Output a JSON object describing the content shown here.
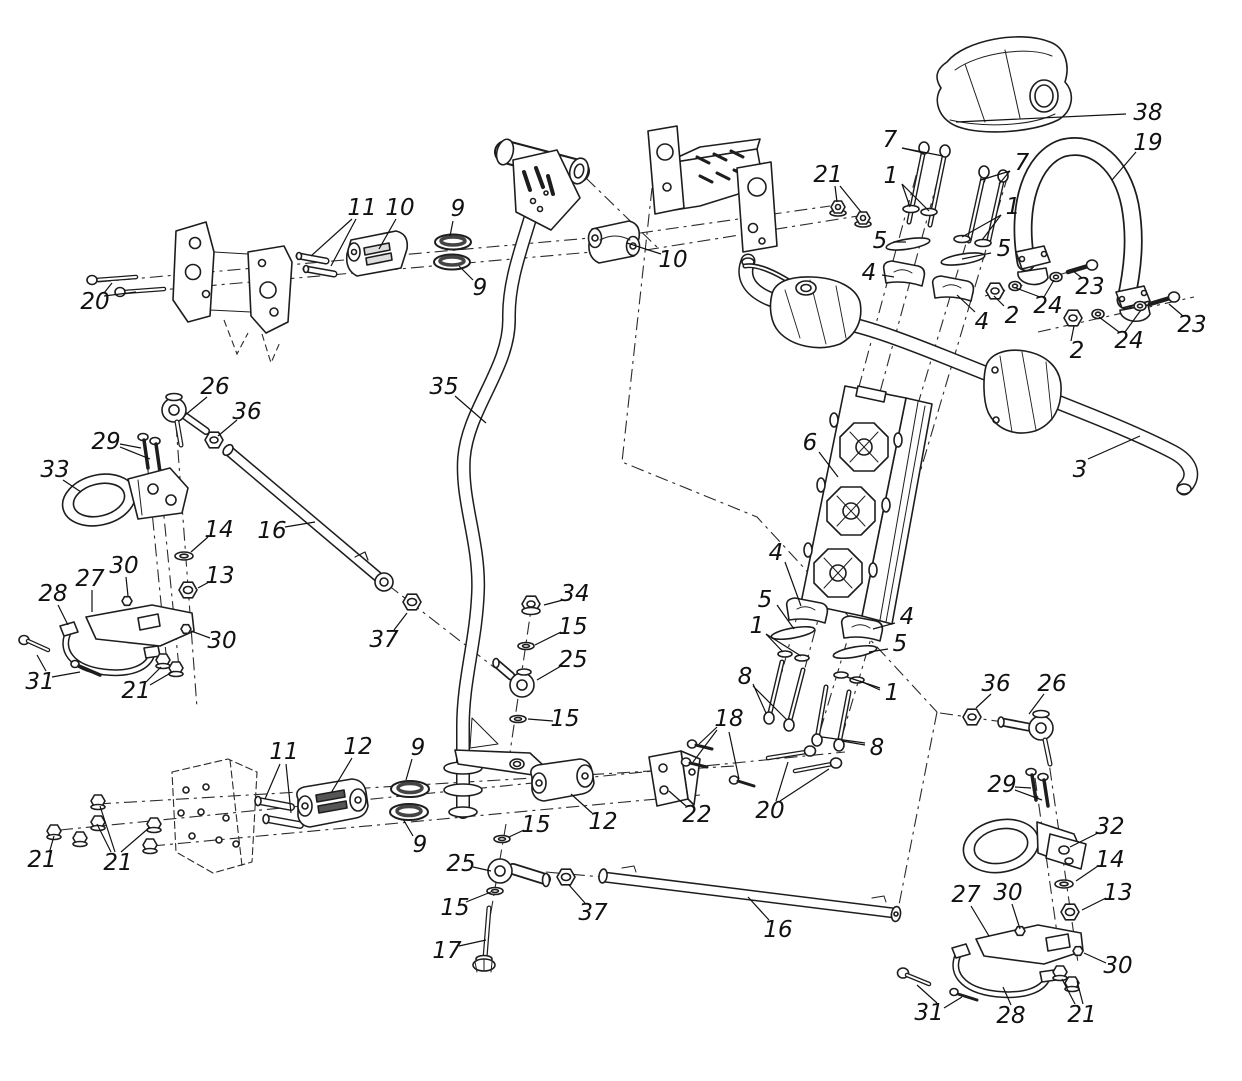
{
  "figure": {
    "kind": "exploded-parts-diagram",
    "subject": "steering assembly"
  },
  "style": {
    "line_color": "#1d1d1d",
    "label_color": "#111111",
    "background": "#ffffff"
  },
  "labels": [
    {
      "t": "38",
      "x": 1148,
      "y": 113,
      "L": [
        [
          1126,
          114,
          956,
          122
        ]
      ]
    },
    {
      "t": "19",
      "x": 1148,
      "y": 143,
      "L": [
        [
          1136,
          152,
          1112,
          180
        ]
      ]
    },
    {
      "t": "7",
      "x": 890,
      "y": 140,
      "L": [
        [
          902,
          148,
          924,
          153
        ],
        [
          902,
          148,
          943,
          156
        ]
      ]
    },
    {
      "t": "1",
      "x": 891,
      "y": 176,
      "L": [
        [
          902,
          184,
          910,
          207
        ],
        [
          902,
          184,
          929,
          211
        ]
      ]
    },
    {
      "t": "7",
      "x": 1022,
      "y": 163,
      "L": [
        [
          1010,
          171,
          981,
          180
        ],
        [
          1010,
          171,
          999,
          184
        ]
      ]
    },
    {
      "t": "1",
      "x": 1013,
      "y": 207,
      "L": [
        [
          1001,
          215,
          962,
          237
        ],
        [
          1001,
          215,
          982,
          240
        ]
      ]
    },
    {
      "t": "5",
      "x": 880,
      "y": 241,
      "L": [
        [
          893,
          242,
          906,
          242
        ]
      ]
    },
    {
      "t": "4",
      "x": 869,
      "y": 273,
      "L": [
        [
          882,
          275,
          894,
          277
        ]
      ]
    },
    {
      "t": "5",
      "x": 1004,
      "y": 249,
      "L": [
        [
          991,
          253,
          962,
          259
        ]
      ]
    },
    {
      "t": "4",
      "x": 982,
      "y": 322,
      "L": [
        [
          975,
          312,
          957,
          295
        ]
      ]
    },
    {
      "t": "21",
      "x": 828,
      "y": 175,
      "L": [
        [
          835,
          186,
          837,
          202
        ],
        [
          840,
          186,
          861,
          212
        ]
      ]
    },
    {
      "t": "2",
      "x": 1012,
      "y": 316,
      "L": [
        [
          1004,
          306,
          994,
          296
        ]
      ]
    },
    {
      "t": "24",
      "x": 1048,
      "y": 306,
      "L": [
        [
          1040,
          297,
          1016,
          288
        ],
        [
          1044,
          297,
          1054,
          280
        ]
      ]
    },
    {
      "t": "23",
      "x": 1090,
      "y": 287,
      "L": [
        [
          1082,
          278,
          1073,
          271
        ]
      ]
    },
    {
      "t": "2",
      "x": 1077,
      "y": 351,
      "L": [
        [
          1071,
          341,
          1074,
          326
        ]
      ]
    },
    {
      "t": "24",
      "x": 1129,
      "y": 341,
      "L": [
        [
          1119,
          332,
          1099,
          317
        ],
        [
          1125,
          332,
          1141,
          310
        ]
      ]
    },
    {
      "t": "23",
      "x": 1192,
      "y": 325,
      "L": [
        [
          1183,
          316,
          1169,
          304
        ]
      ]
    },
    {
      "t": "3",
      "x": 1080,
      "y": 470,
      "L": [
        [
          1088,
          459,
          1140,
          436
        ]
      ]
    },
    {
      "t": "11",
      "x": 362,
      "y": 208,
      "L": [
        [
          352,
          219,
          311,
          256
        ],
        [
          356,
          219,
          331,
          266
        ]
      ]
    },
    {
      "t": "10",
      "x": 400,
      "y": 208,
      "L": [
        [
          396,
          219,
          379,
          249
        ]
      ]
    },
    {
      "t": "9",
      "x": 458,
      "y": 209,
      "L": [
        [
          453,
          221,
          450,
          236
        ]
      ]
    },
    {
      "t": "9",
      "x": 480,
      "y": 288,
      "L": [
        [
          473,
          280,
          459,
          266
        ]
      ]
    },
    {
      "t": "10",
      "x": 673,
      "y": 260,
      "L": [
        [
          661,
          254,
          627,
          243
        ]
      ]
    },
    {
      "t": "20",
      "x": 95,
      "y": 302,
      "L": [
        [
          104,
          293,
          112,
          283
        ],
        [
          104,
          296,
          136,
          292
        ]
      ]
    },
    {
      "t": "35",
      "x": 444,
      "y": 387,
      "L": [
        [
          455,
          396,
          486,
          423
        ]
      ]
    },
    {
      "t": "6",
      "x": 810,
      "y": 443,
      "L": [
        [
          819,
          452,
          838,
          477
        ]
      ]
    },
    {
      "t": "16",
      "x": 272,
      "y": 531,
      "L": [
        [
          285,
          527,
          315,
          522
        ]
      ]
    },
    {
      "t": "26",
      "x": 215,
      "y": 387,
      "L": [
        [
          207,
          397,
          184,
          416
        ]
      ]
    },
    {
      "t": "36",
      "x": 247,
      "y": 412,
      "L": [
        [
          237,
          420,
          218,
          436
        ]
      ]
    },
    {
      "t": "29",
      "x": 106,
      "y": 442,
      "L": [
        [
          120,
          444,
          141,
          448
        ],
        [
          120,
          447,
          150,
          459
        ]
      ]
    },
    {
      "t": "33",
      "x": 55,
      "y": 470,
      "L": [
        [
          63,
          480,
          81,
          492
        ]
      ]
    },
    {
      "t": "14",
      "x": 219,
      "y": 530,
      "L": [
        [
          208,
          537,
          191,
          552
        ]
      ]
    },
    {
      "t": "13",
      "x": 220,
      "y": 576,
      "L": [
        [
          209,
          582,
          198,
          588
        ]
      ]
    },
    {
      "t": "30",
      "x": 124,
      "y": 566,
      "L": [
        [
          126,
          577,
          128,
          596
        ]
      ]
    },
    {
      "t": "27",
      "x": 90,
      "y": 579,
      "L": [
        [
          92,
          590,
          92,
          612
        ]
      ]
    },
    {
      "t": "28",
      "x": 53,
      "y": 594,
      "L": [
        [
          58,
          605,
          68,
          625
        ]
      ]
    },
    {
      "t": "30",
      "x": 222,
      "y": 641,
      "L": [
        [
          210,
          638,
          191,
          631
        ]
      ]
    },
    {
      "t": "31",
      "x": 40,
      "y": 682,
      "L": [
        [
          46,
          671,
          37,
          655
        ],
        [
          52,
          677,
          80,
          672
        ]
      ]
    },
    {
      "t": "21",
      "x": 136,
      "y": 691,
      "L": [
        [
          146,
          682,
          161,
          667
        ],
        [
          150,
          685,
          174,
          671
        ]
      ]
    },
    {
      "t": "34",
      "x": 575,
      "y": 594,
      "L": [
        [
          563,
          600,
          544,
          605
        ]
      ]
    },
    {
      "t": "15",
      "x": 573,
      "y": 627,
      "L": [
        [
          561,
          632,
          535,
          645
        ]
      ]
    },
    {
      "t": "25",
      "x": 573,
      "y": 660,
      "L": [
        [
          561,
          666,
          537,
          680
        ]
      ]
    },
    {
      "t": "15",
      "x": 565,
      "y": 719,
      "L": [
        [
          553,
          721,
          528,
          719
        ]
      ]
    },
    {
      "t": "37",
      "x": 384,
      "y": 640,
      "L": [
        [
          394,
          630,
          407,
          613
        ]
      ]
    },
    {
      "t": "18",
      "x": 729,
      "y": 719,
      "L": [
        [
          717,
          727,
          699,
          744
        ],
        [
          717,
          730,
          693,
          762
        ],
        [
          729,
          732,
          739,
          779
        ]
      ]
    },
    {
      "t": "8",
      "x": 745,
      "y": 677,
      "L": [
        [
          753,
          684,
          766,
          713
        ],
        [
          753,
          686,
          787,
          720
        ]
      ]
    },
    {
      "t": "1",
      "x": 757,
      "y": 626,
      "L": [
        [
          766,
          634,
          783,
          652
        ],
        [
          766,
          634,
          801,
          656
        ]
      ]
    },
    {
      "t": "4",
      "x": 907,
      "y": 617,
      "L": [
        [
          895,
          623,
          873,
          629
        ]
      ]
    },
    {
      "t": "5",
      "x": 900,
      "y": 644,
      "L": [
        [
          888,
          649,
          869,
          652
        ]
      ]
    },
    {
      "t": "1",
      "x": 892,
      "y": 693,
      "L": [
        [
          880,
          688,
          847,
          677
        ],
        [
          880,
          690,
          860,
          681
        ]
      ]
    },
    {
      "t": "8",
      "x": 877,
      "y": 748,
      "L": [
        [
          865,
          743,
          822,
          737
        ],
        [
          865,
          745,
          842,
          741
        ]
      ]
    },
    {
      "t": "22",
      "x": 697,
      "y": 815,
      "L": [
        [
          686,
          806,
          669,
          791
        ]
      ]
    },
    {
      "t": "20",
      "x": 770,
      "y": 811,
      "L": [
        [
          776,
          801,
          788,
          762
        ],
        [
          780,
          801,
          829,
          769
        ]
      ]
    },
    {
      "t": "12",
      "x": 603,
      "y": 822,
      "L": [
        [
          592,
          813,
          571,
          794
        ]
      ]
    },
    {
      "t": "15",
      "x": 536,
      "y": 825,
      "L": [
        [
          524,
          830,
          509,
          837
        ]
      ]
    },
    {
      "t": "25",
      "x": 461,
      "y": 864,
      "L": [
        [
          473,
          867,
          491,
          871
        ]
      ]
    },
    {
      "t": "15",
      "x": 455,
      "y": 908,
      "L": [
        [
          466,
          902,
          491,
          892
        ]
      ]
    },
    {
      "t": "17",
      "x": 447,
      "y": 951,
      "L": [
        [
          459,
          946,
          486,
          940
        ]
      ]
    },
    {
      "t": "37",
      "x": 593,
      "y": 913,
      "L": [
        [
          585,
          903,
          569,
          885
        ]
      ]
    },
    {
      "t": "16",
      "x": 778,
      "y": 930,
      "L": [
        [
          769,
          920,
          748,
          897
        ]
      ]
    },
    {
      "t": "11",
      "x": 284,
      "y": 752,
      "L": [
        [
          280,
          764,
          265,
          799
        ],
        [
          286,
          764,
          291,
          813
        ]
      ]
    },
    {
      "t": "12",
      "x": 358,
      "y": 747,
      "L": [
        [
          352,
          758,
          331,
          793
        ]
      ]
    },
    {
      "t": "9",
      "x": 418,
      "y": 748,
      "L": [
        [
          412,
          759,
          406,
          780
        ]
      ]
    },
    {
      "t": "9",
      "x": 420,
      "y": 845,
      "L": [
        [
          413,
          836,
          403,
          819
        ]
      ]
    },
    {
      "t": "21",
      "x": 42,
      "y": 860,
      "L": [
        [
          50,
          850,
          54,
          836
        ]
      ]
    },
    {
      "t": "21",
      "x": 118,
      "y": 863,
      "L": [
        [
          111,
          852,
          97,
          824
        ],
        [
          115,
          852,
          100,
          806
        ],
        [
          121,
          852,
          150,
          827
        ]
      ]
    },
    {
      "t": "36",
      "x": 996,
      "y": 684,
      "L": [
        [
          991,
          694,
          976,
          708
        ]
      ]
    },
    {
      "t": "26",
      "x": 1052,
      "y": 684,
      "L": [
        [
          1044,
          694,
          1029,
          714
        ]
      ]
    },
    {
      "t": "29",
      "x": 1002,
      "y": 785,
      "L": [
        [
          1015,
          787,
          1031,
          788
        ],
        [
          1015,
          790,
          1042,
          800
        ]
      ]
    },
    {
      "t": "32",
      "x": 1110,
      "y": 827,
      "L": [
        [
          1098,
          833,
          1070,
          847
        ]
      ]
    },
    {
      "t": "14",
      "x": 1110,
      "y": 860,
      "L": [
        [
          1098,
          866,
          1076,
          881
        ]
      ]
    },
    {
      "t": "13",
      "x": 1118,
      "y": 893,
      "L": [
        [
          1106,
          898,
          1082,
          910
        ]
      ]
    },
    {
      "t": "27",
      "x": 966,
      "y": 895,
      "L": [
        [
          971,
          906,
          989,
          936
        ]
      ]
    },
    {
      "t": "30",
      "x": 1008,
      "y": 893,
      "L": [
        [
          1012,
          904,
          1020,
          929
        ]
      ]
    },
    {
      "t": "30",
      "x": 1118,
      "y": 966,
      "L": [
        [
          1106,
          963,
          1084,
          953
        ]
      ]
    },
    {
      "t": "31",
      "x": 929,
      "y": 1013,
      "L": [
        [
          937,
          1003,
          917,
          985
        ],
        [
          944,
          1008,
          962,
          997
        ]
      ]
    },
    {
      "t": "28",
      "x": 1011,
      "y": 1016,
      "L": [
        [
          1011,
          1005,
          1003,
          987
        ]
      ]
    },
    {
      "t": "21",
      "x": 1082,
      "y": 1015,
      "L": [
        [
          1075,
          1004,
          1062,
          979
        ],
        [
          1083,
          1004,
          1077,
          981
        ]
      ]
    },
    {
      "t": "4",
      "x": 776,
      "y": 553,
      "L": [
        [
          785,
          562,
          801,
          606
        ]
      ]
    },
    {
      "t": "5",
      "x": 765,
      "y": 600,
      "L": [
        [
          777,
          605,
          794,
          629
        ]
      ]
    }
  ]
}
